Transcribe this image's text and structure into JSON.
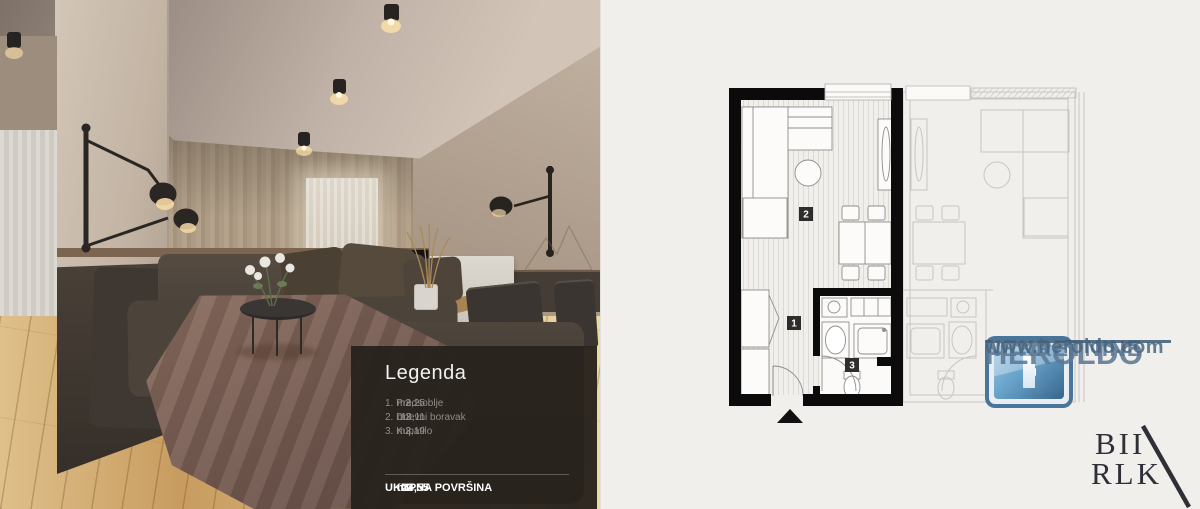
{
  "legend": {
    "title": "Legenda",
    "items": [
      {
        "name": "1. Predsoblje",
        "value": "3,25",
        "unit": "m2"
      },
      {
        "name": "2. Dnevni boravak",
        "value": "18,11",
        "unit": "m2"
      },
      {
        "name": "3. Kupatilo",
        "value": "3,19",
        "unit": "m2"
      }
    ],
    "total": {
      "label": "UKUPNA POVRŠINA",
      "value": "24,55",
      "unit": "m2"
    }
  },
  "floorplan": {
    "room_labels": {
      "hallway": "1",
      "living": "2",
      "bathroom": "3"
    },
    "colors": {
      "wall": "#0b0b0b",
      "fixture_line": "#8f8d89",
      "ghost_line": "#c8c6c2",
      "background": "#f1efec",
      "floor_hatch": "#dbd9d4"
    }
  },
  "branding": {
    "company": "HEROLDO",
    "tagline": "NEKRETNINE",
    "website": "www.heroldo.com",
    "watermark": {
      "line1": "BII",
      "line2": "RLK"
    },
    "colors": {
      "text": "#5c7894",
      "icon_blue": "#3c6c96"
    }
  }
}
